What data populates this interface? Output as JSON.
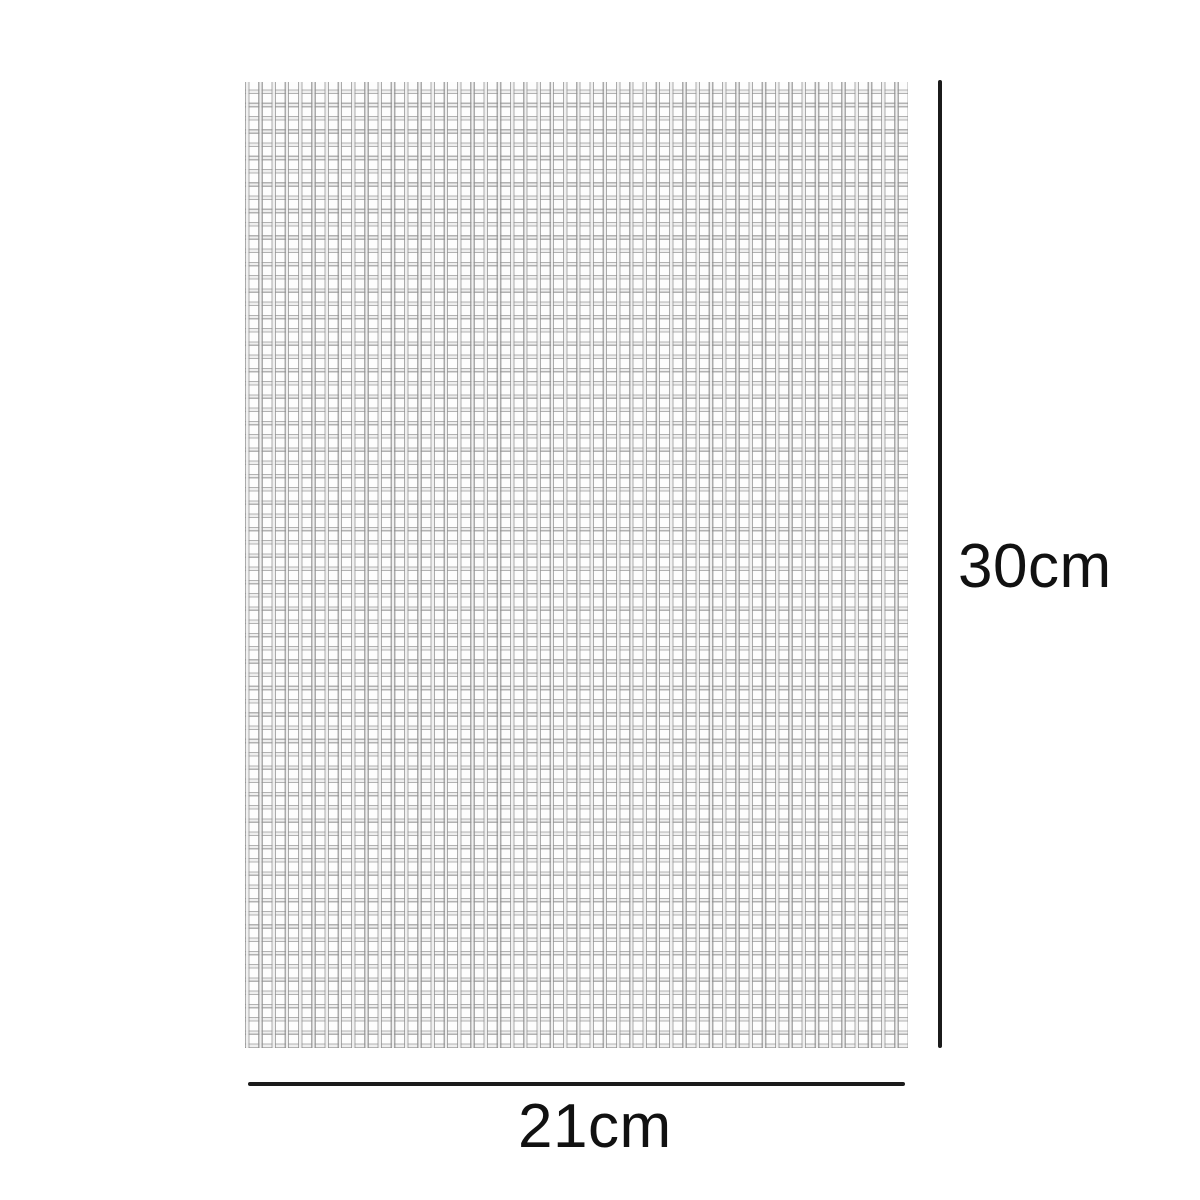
{
  "diagram": {
    "type": "product-dimension-diagram",
    "product": "woven mesh fabric sheet",
    "height_label": "30cm",
    "width_label": "21cm"
  },
  "colors": {
    "background": "#ffffff",
    "dimension_line": "#1b1b1b",
    "label_text": "#111111",
    "mesh_wire": "#8f8f8f",
    "mesh_wire_highlight": "#f0f0f0",
    "mesh_background": "#fdfdfd"
  }
}
